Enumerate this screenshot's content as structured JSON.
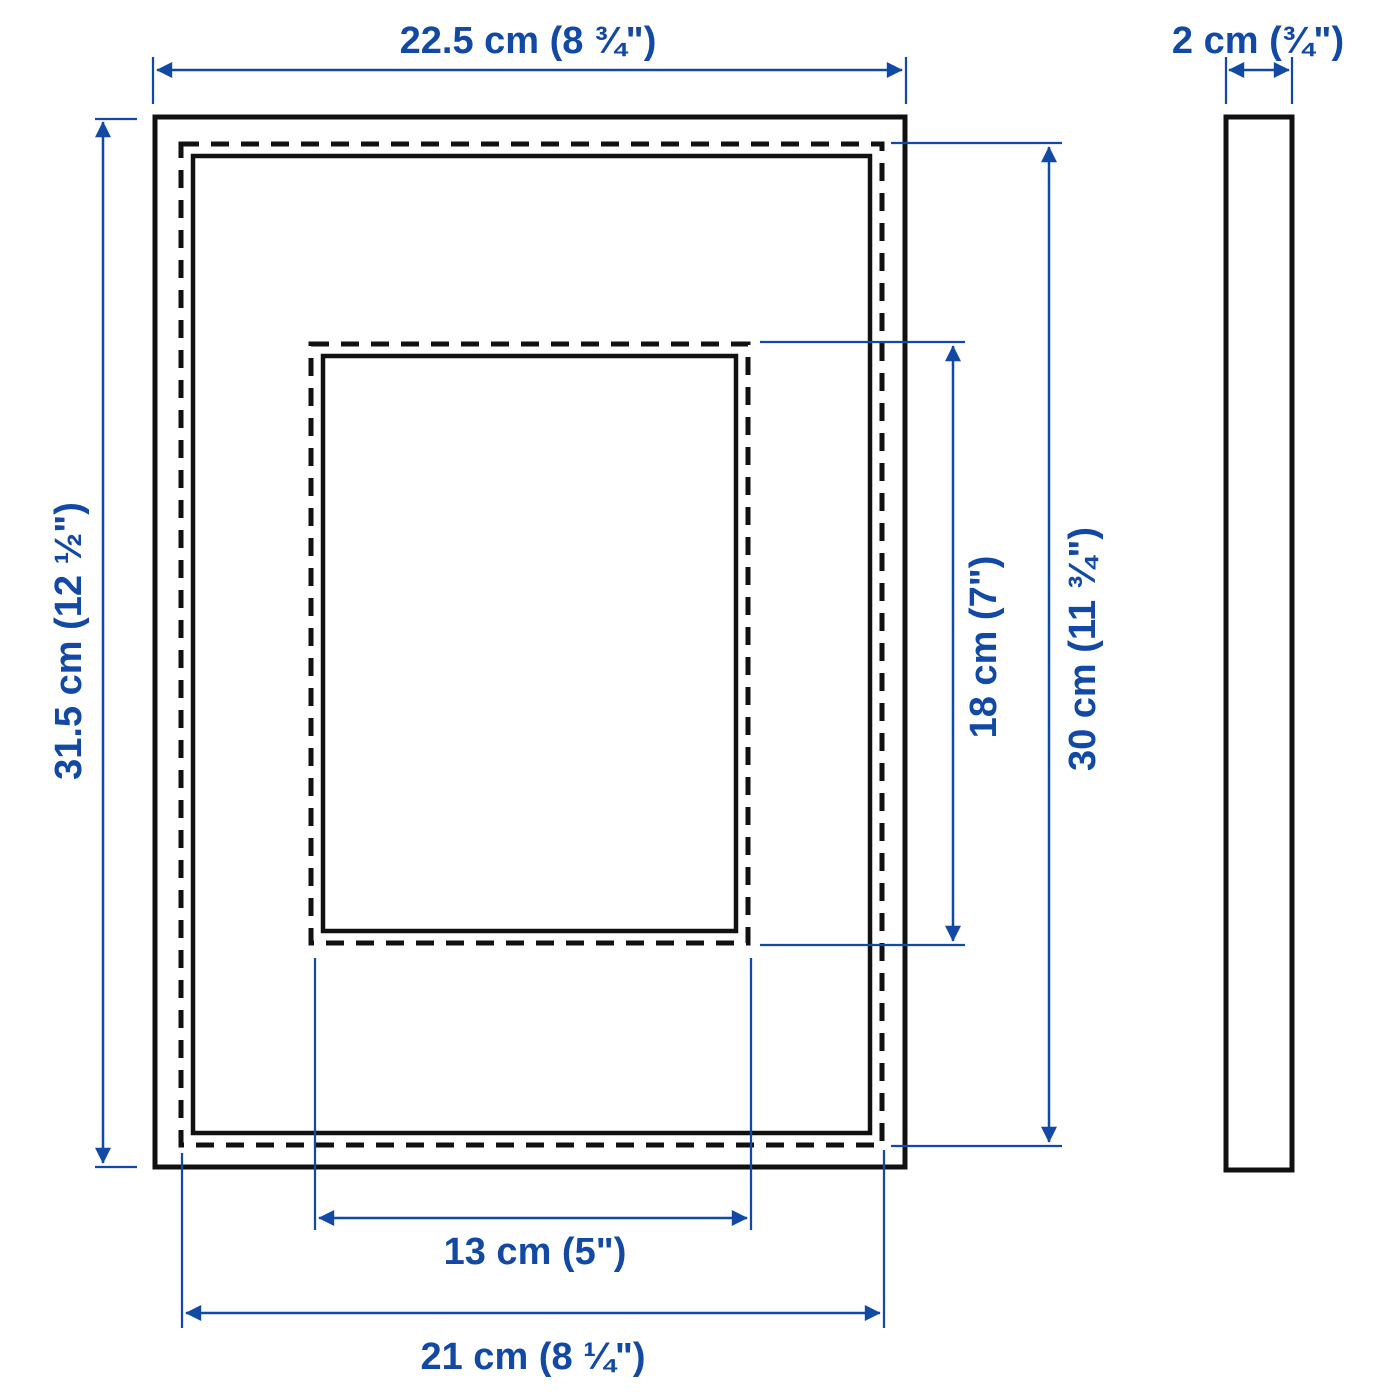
{
  "diagram": {
    "accent_color": "#1149a5",
    "line_color": "#111111",
    "background_color": "#ffffff",
    "front_view": {
      "outer_width_label": "22.5 cm (8 ¾\")",
      "outer_height_label": "31.5 cm (12 ½\")",
      "back_width_label": "21 cm (8 ¼\")",
      "back_height_label": "30 cm (11 ¾\")",
      "opening_width_label": "13 cm (5\")",
      "opening_height_label": "18 cm (7\")"
    },
    "side_view": {
      "thickness_label": "2 cm (¾\")"
    }
  }
}
